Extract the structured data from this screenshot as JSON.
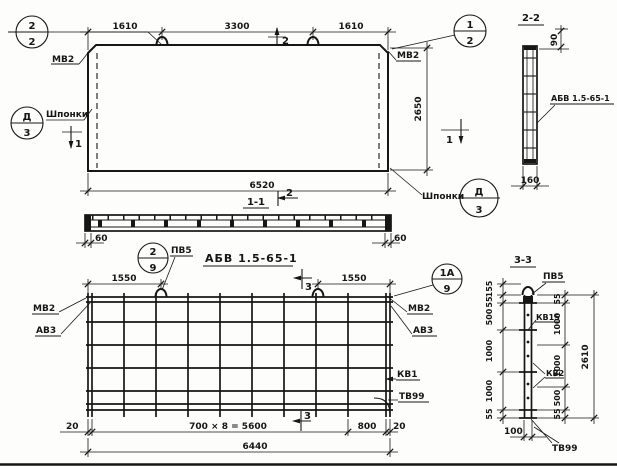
{
  "elevation": {
    "callout_2_2": {
      "top": "2",
      "bottom": "2"
    },
    "callout_1_2": {
      "top": "1",
      "bottom": "2"
    },
    "callout_keys_left": {
      "top": "Д",
      "bottom": "3",
      "label": "Шпонки"
    },
    "callout_keys_right": {
      "top": "Д",
      "bottom": "3",
      "label": "Шпонки"
    },
    "plate_label_left": "МВ2",
    "plate_label_right": "МВ2",
    "dim_top": [
      "1610",
      "3300",
      "1610"
    ],
    "dim_height": "2650",
    "dim_width": "6520",
    "cut_mark_2": "2",
    "cut_mark_1_left": "1",
    "cut_mark_1_right": "1"
  },
  "section_1_1": {
    "title": "1-1",
    "cut_mark_2": "2",
    "dim_end_left": "60",
    "dim_end_right": "60"
  },
  "section_2_2": {
    "title": "2-2",
    "dim_top": "90",
    "dim_bottom": "160",
    "mesh_label": "АБВ 1.5-65-1"
  },
  "plan": {
    "title": "АБВ 1.5-65-1",
    "callout_2_9": {
      "top": "2",
      "bottom": "9",
      "label": "ПВ5"
    },
    "callout_1a_9": {
      "top": "1А",
      "bottom": "9"
    },
    "dim_hook_left": "1550",
    "dim_hook_right": "1550",
    "bar_labels_left": [
      "МВ2",
      "АВ3"
    ],
    "bar_labels_right": [
      "МВ2",
      "АВ3"
    ],
    "mesh_label": "КВ1",
    "wire_label": "ТВ99",
    "cut_mark_3_top": "3",
    "cut_mark_3_bottom": "3",
    "dims_bottom": [
      "20",
      "700 × 8 = 5600",
      "800",
      "20"
    ],
    "dim_total": "6440"
  },
  "section_3_3": {
    "title": "3-3",
    "hook_label": "ПВ5",
    "labels": {
      "kv15": "КВ15",
      "kv2": "КВ2",
      "tv99": "ТВ99"
    },
    "dims_left": [
      "155",
      "55",
      "500",
      "1000",
      "1000",
      "55"
    ],
    "dims_right": [
      "55",
      "1000",
      "1000",
      "500",
      "55"
    ],
    "dim_total": "2610",
    "dim_bottom": "100"
  }
}
